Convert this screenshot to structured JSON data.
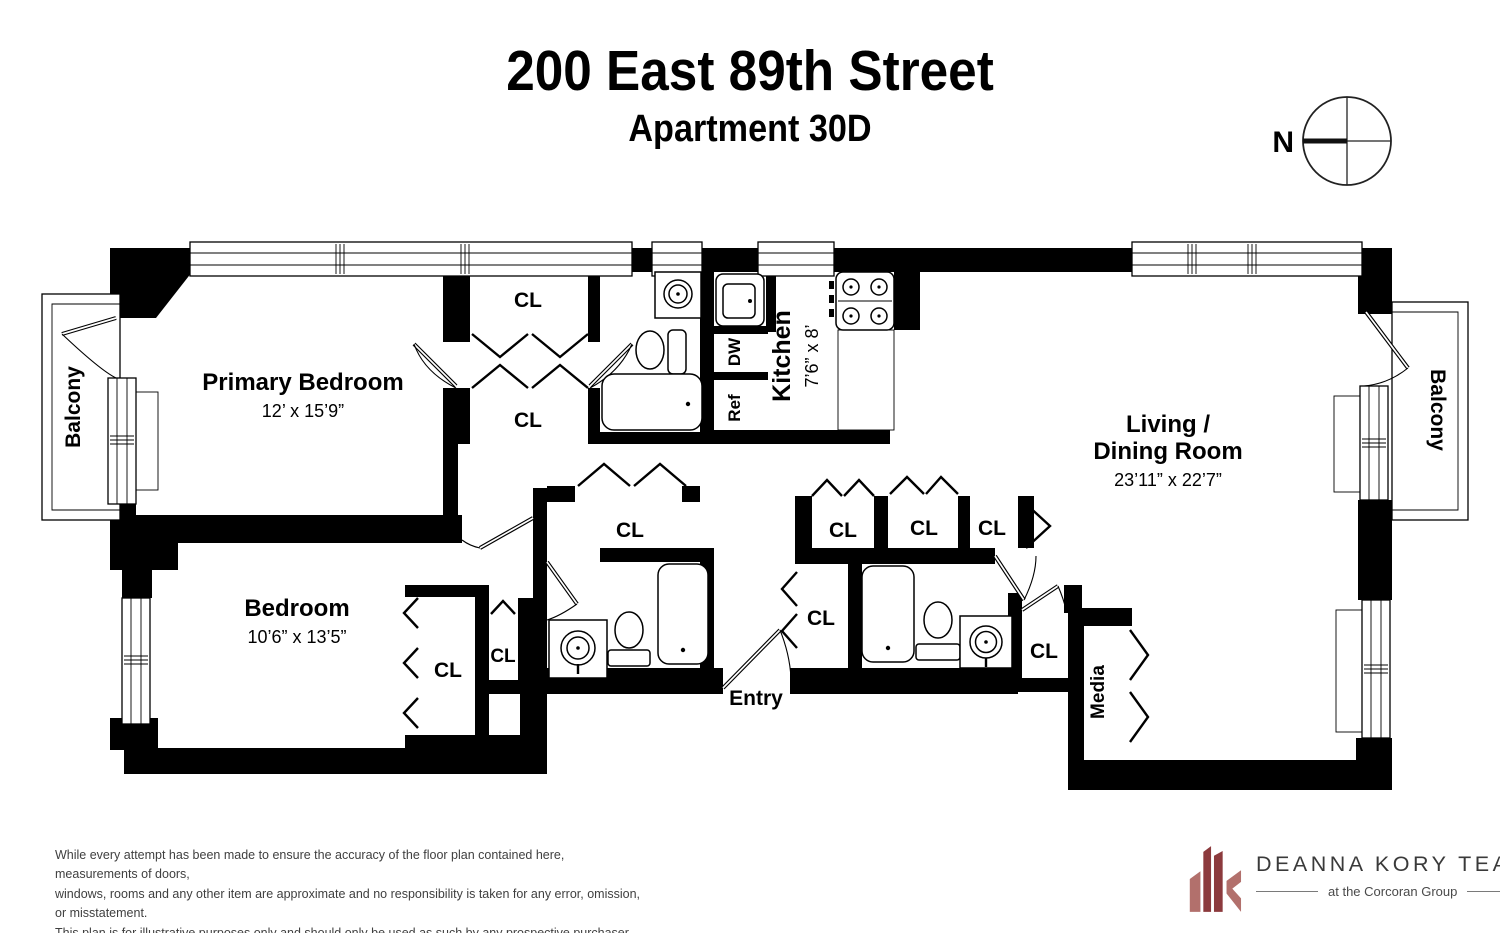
{
  "header": {
    "title": "200 East 89th Street",
    "subtitle": "Apartment 30D"
  },
  "compass": {
    "north_label": "N"
  },
  "rooms": {
    "primary_bedroom": {
      "name": "Primary Bedroom",
      "dims": "12’ x 15’9”"
    },
    "bedroom": {
      "name": "Bedroom",
      "dims": "10’6” x 13’5”"
    },
    "living_dining": {
      "line1": "Living /",
      "line2": "Dining Room",
      "dims": "23’11” x 22’7”"
    },
    "kitchen": {
      "name": "Kitchen",
      "dims": "7’6” x 8’"
    },
    "entry": {
      "name": "Entry"
    },
    "media": {
      "name": "Media"
    },
    "balcony": {
      "name": "Balcony"
    }
  },
  "labels": {
    "closet": "CL",
    "dishwasher": "DW",
    "refrigerator": "Ref"
  },
  "footer": {
    "disclaimer": {
      "line1": "While every attempt has been made to ensure the accuracy of the floor plan contained here, measurements of doors,",
      "line2": "windows, rooms and any other item are approximate and no responsibility is taken for any error, omission, or misstatement.",
      "line3": "This plan is for illustrative purposes only and should only be used as such by any prospective purchaser."
    },
    "logo": {
      "team": "DEANNA KORY TEAM",
      "tagline": "at the Corcoran Group"
    }
  },
  "colors": {
    "wall": "#000000",
    "logo_dark_red": "#8c3a3d",
    "logo_light_red": "#b2706c",
    "disclaimer_text": "#3f3f3f",
    "logo_text": "#3a3a3a"
  }
}
